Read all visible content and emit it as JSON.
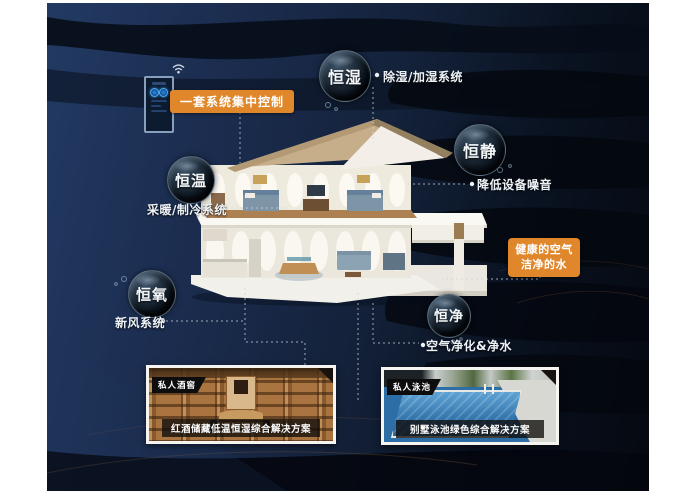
{
  "scene": {
    "colors": {
      "navy": "#1b2c4e",
      "deep_black": "#05080f",
      "accent_orange": "#e0862b",
      "line": "#cdd6e0"
    }
  },
  "control_panel": {
    "label": "一套系统集中控制"
  },
  "features": [
    {
      "key": "heng-shi",
      "bubble": "恒湿",
      "system": "除湿/加湿系统"
    },
    {
      "key": "heng-jing",
      "bubble": "恒静",
      "system": "降低设备噪音"
    },
    {
      "key": "heng-wen",
      "bubble": "恒温",
      "system": "采暖/制冷系统"
    },
    {
      "key": "heng-yang",
      "bubble": "恒氧",
      "system": "新风系统"
    },
    {
      "key": "heng-jing2",
      "bubble": "恒净",
      "system": "空气净化&净水"
    }
  ],
  "highlight_box": {
    "line1": "健康的空气",
    "line2": "洁净的水"
  },
  "cards": [
    {
      "badge": "私人酒窖",
      "caption": "红酒储藏低温恒湿综合解决方案"
    },
    {
      "badge": "私人泳池",
      "caption": "别墅泳池绿色综合解决方案"
    }
  ]
}
